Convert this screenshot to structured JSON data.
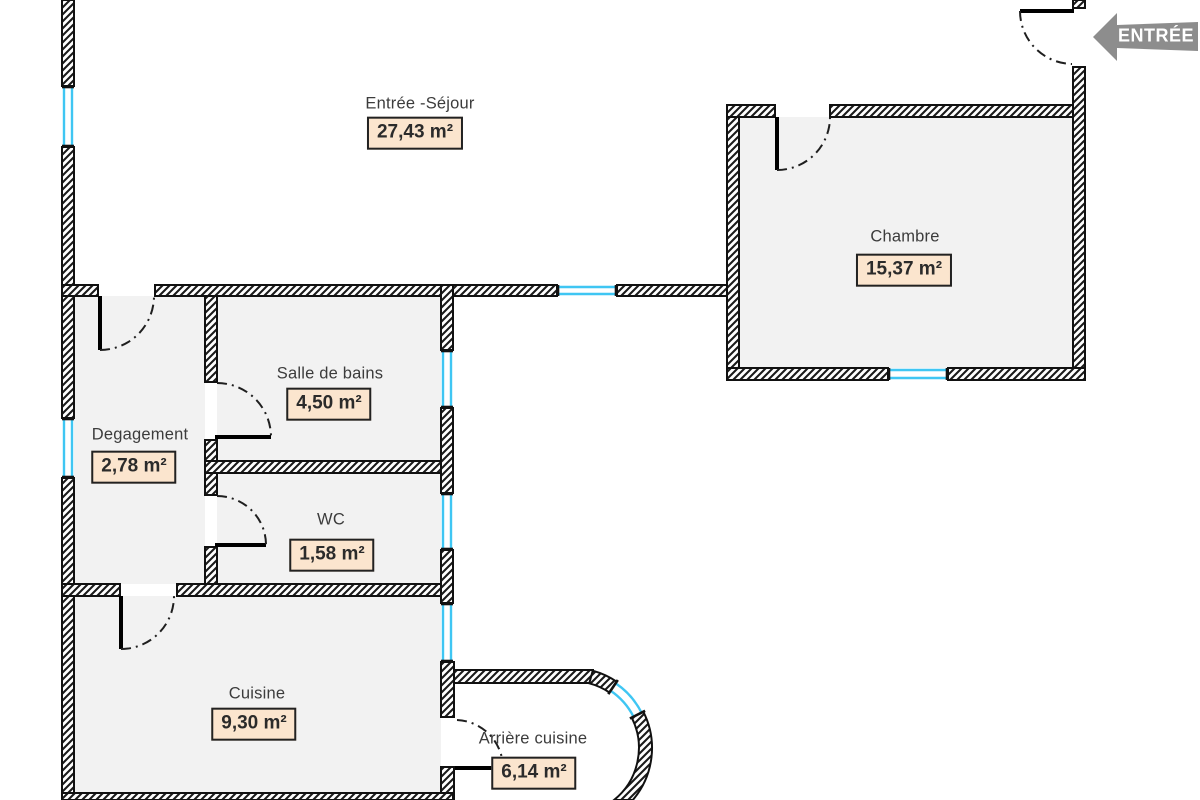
{
  "entry": {
    "label": "ENTRÉE"
  },
  "rooms": [
    {
      "id": "entree-sejour",
      "name": "Entrée -Séjour",
      "area": "27,43 m²"
    },
    {
      "id": "chambre",
      "name": "Chambre",
      "area": "15,37 m²"
    },
    {
      "id": "salle-de-bains",
      "name": "Salle de bains",
      "area": "4,50 m²"
    },
    {
      "id": "degagement",
      "name": "Degagement",
      "area": "2,78 m²"
    },
    {
      "id": "wc",
      "name": "WC",
      "area": "1,58 m²"
    },
    {
      "id": "cuisine",
      "name": "Cuisine",
      "area": "9,30 m²"
    },
    {
      "id": "arriere-cuisine",
      "name": "Arrière cuisine",
      "area": "6,14 m²"
    }
  ],
  "colors": {
    "wall_line": "#1a1a1a",
    "window_glass": "#3fc6f3",
    "room_fill": "#f2f2f2",
    "area_badge_fill": "#fbe5ce",
    "area_badge_border": "#222222",
    "entry_arrow": "#8d8d8d",
    "label_text": "#3c3c3c"
  }
}
